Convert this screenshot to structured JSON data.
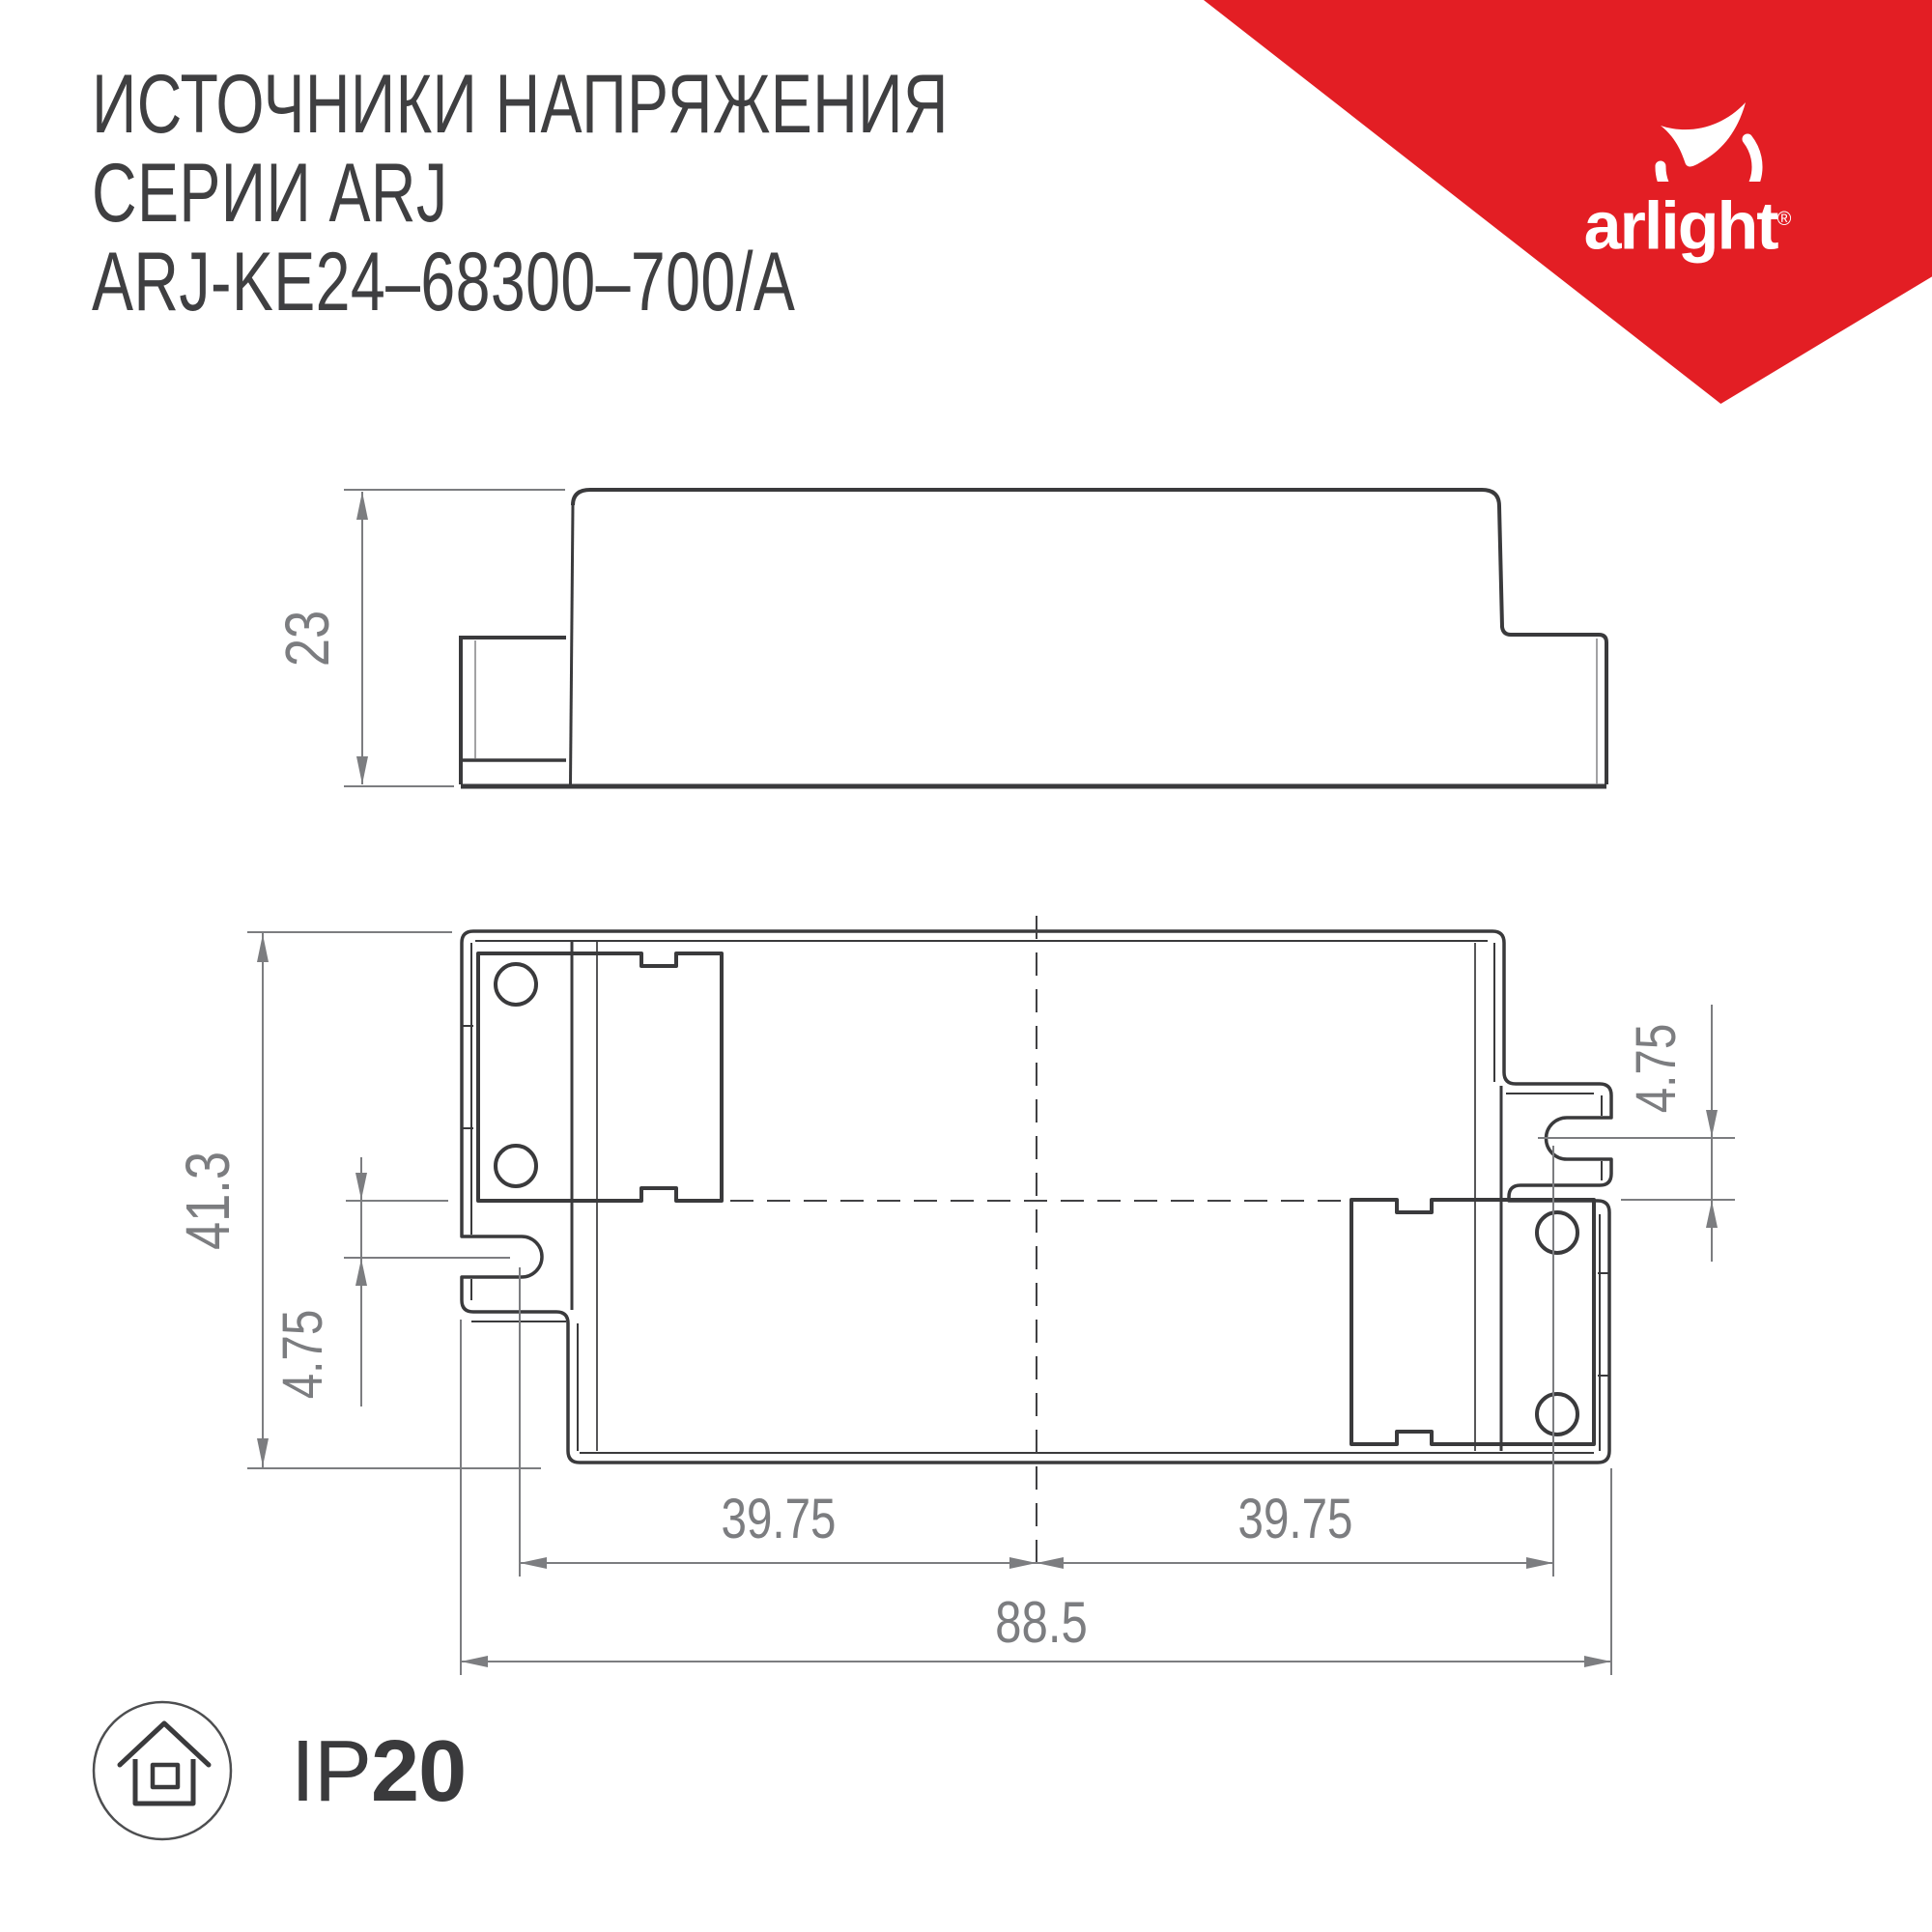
{
  "header": {
    "line1": "ИСТОЧНИКИ НАПРЯЖЕНИЯ",
    "line2": "СЕРИИ ARJ",
    "line3": "ARJ-KE24–68300–700/A"
  },
  "brand": {
    "name": "arlight",
    "registered_mark": "®",
    "accent_color": "#e31e24"
  },
  "drawing": {
    "side_view": {
      "height_mm": "23"
    },
    "top_view": {
      "overall_height_mm": "41.3",
      "slot_offset_left_mm": "4.75",
      "slot_offset_right_mm": "4.75",
      "slot_spacing_left_mm": "39.75",
      "slot_spacing_right_mm": "39.75",
      "overall_width_mm": "88.5"
    }
  },
  "protection": {
    "prefix": "IP",
    "rating": "20"
  },
  "colors": {
    "line_dark": "#3a3a3c",
    "dim_gray": "#7c7d80"
  }
}
